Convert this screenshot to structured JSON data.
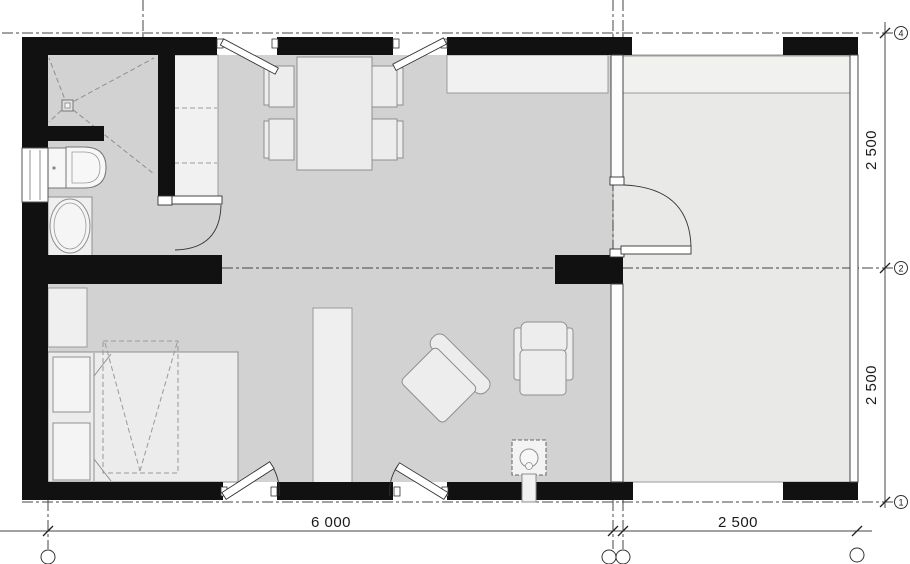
{
  "plan": {
    "type": "architectural-floor-plan",
    "legend": [
      "exterior-wall",
      "interior-wall",
      "window",
      "glazed-partition",
      "door-swing",
      "shower",
      "floor-drain",
      "toilet",
      "washbasin",
      "bathroom-door",
      "kitchen-tall-cabinet",
      "kitchen-counter",
      "dining-table",
      "dining-chair",
      "wardrobe",
      "double-bed",
      "pillow",
      "shelf-unit",
      "armchair-rotated",
      "armchair",
      "stove-fireplace",
      "terrace",
      "terrace-bench",
      "terrace-door",
      "grid-axis",
      "dimension-line"
    ]
  },
  "dimensions": {
    "bottom": [
      {
        "label": "6 000"
      },
      {
        "label": "2 500"
      }
    ],
    "right": [
      {
        "label": "2 500"
      },
      {
        "label": "2 500"
      }
    ]
  },
  "grid_axes": {
    "right_markers": [
      {
        "label": "4"
      },
      {
        "label": "2"
      },
      {
        "label": "1"
      }
    ],
    "bottom_markers": [
      {
        "label": ""
      },
      {
        "label": ""
      },
      {
        "label": ""
      },
      {
        "label": ""
      }
    ]
  },
  "colors": {
    "wall": "#111111",
    "floor_main": "#d2d2d2",
    "floor_terrace": "#e9e9e8",
    "furniture_fill": "#ededed",
    "furniture_stroke": "#8f8f8f",
    "fixture_fill": "#f7f7f7",
    "cabinet_fill": "#f1f1f1",
    "grid_line": "#444444",
    "dimension_text": "#1a1a1a"
  }
}
